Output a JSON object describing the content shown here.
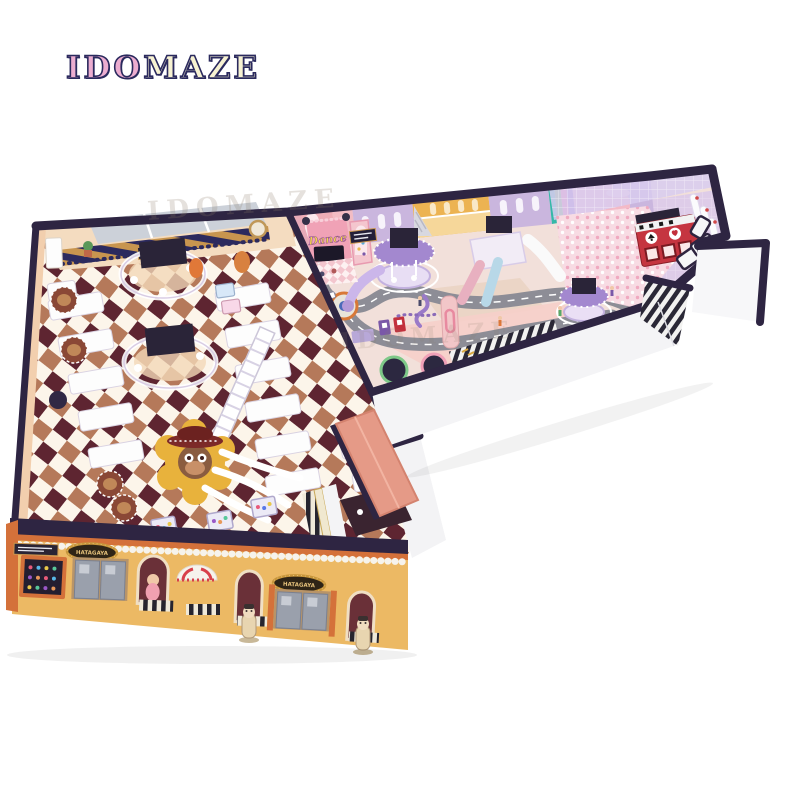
{
  "logo": {
    "first": "IDO",
    "second": "MAZE"
  },
  "watermark": {
    "text": "IDOMAZE"
  },
  "scene": {
    "signs": {
      "dance": "Dance",
      "storefront_left": "HATAGAYA",
      "storefront_right": "HATAGAYA"
    },
    "palette": {
      "navy": "#2e2542",
      "facade_yellow": "#ecb964",
      "facade_orange": "#d4713a",
      "wall_white": "#f4f4f6",
      "checker_tan": "#b5795a",
      "checker_dark": "#5e2531",
      "checker_light": "#fcf5ea",
      "right_floor": "#f2e0da",
      "lavender_wall": "#cab6de",
      "road_gray": "#8d8d96",
      "entrance_roof_pink": "#e59a87",
      "red_cube": "#c53540",
      "ballpit_pink": "#f8dbe3",
      "stage_pink": "#f0a2b6",
      "awning_gold": "#c8914c",
      "carousel_purple": "#a388cf",
      "table_white": "#fdfdfd",
      "rug_gold": "#e8b23c"
    }
  }
}
